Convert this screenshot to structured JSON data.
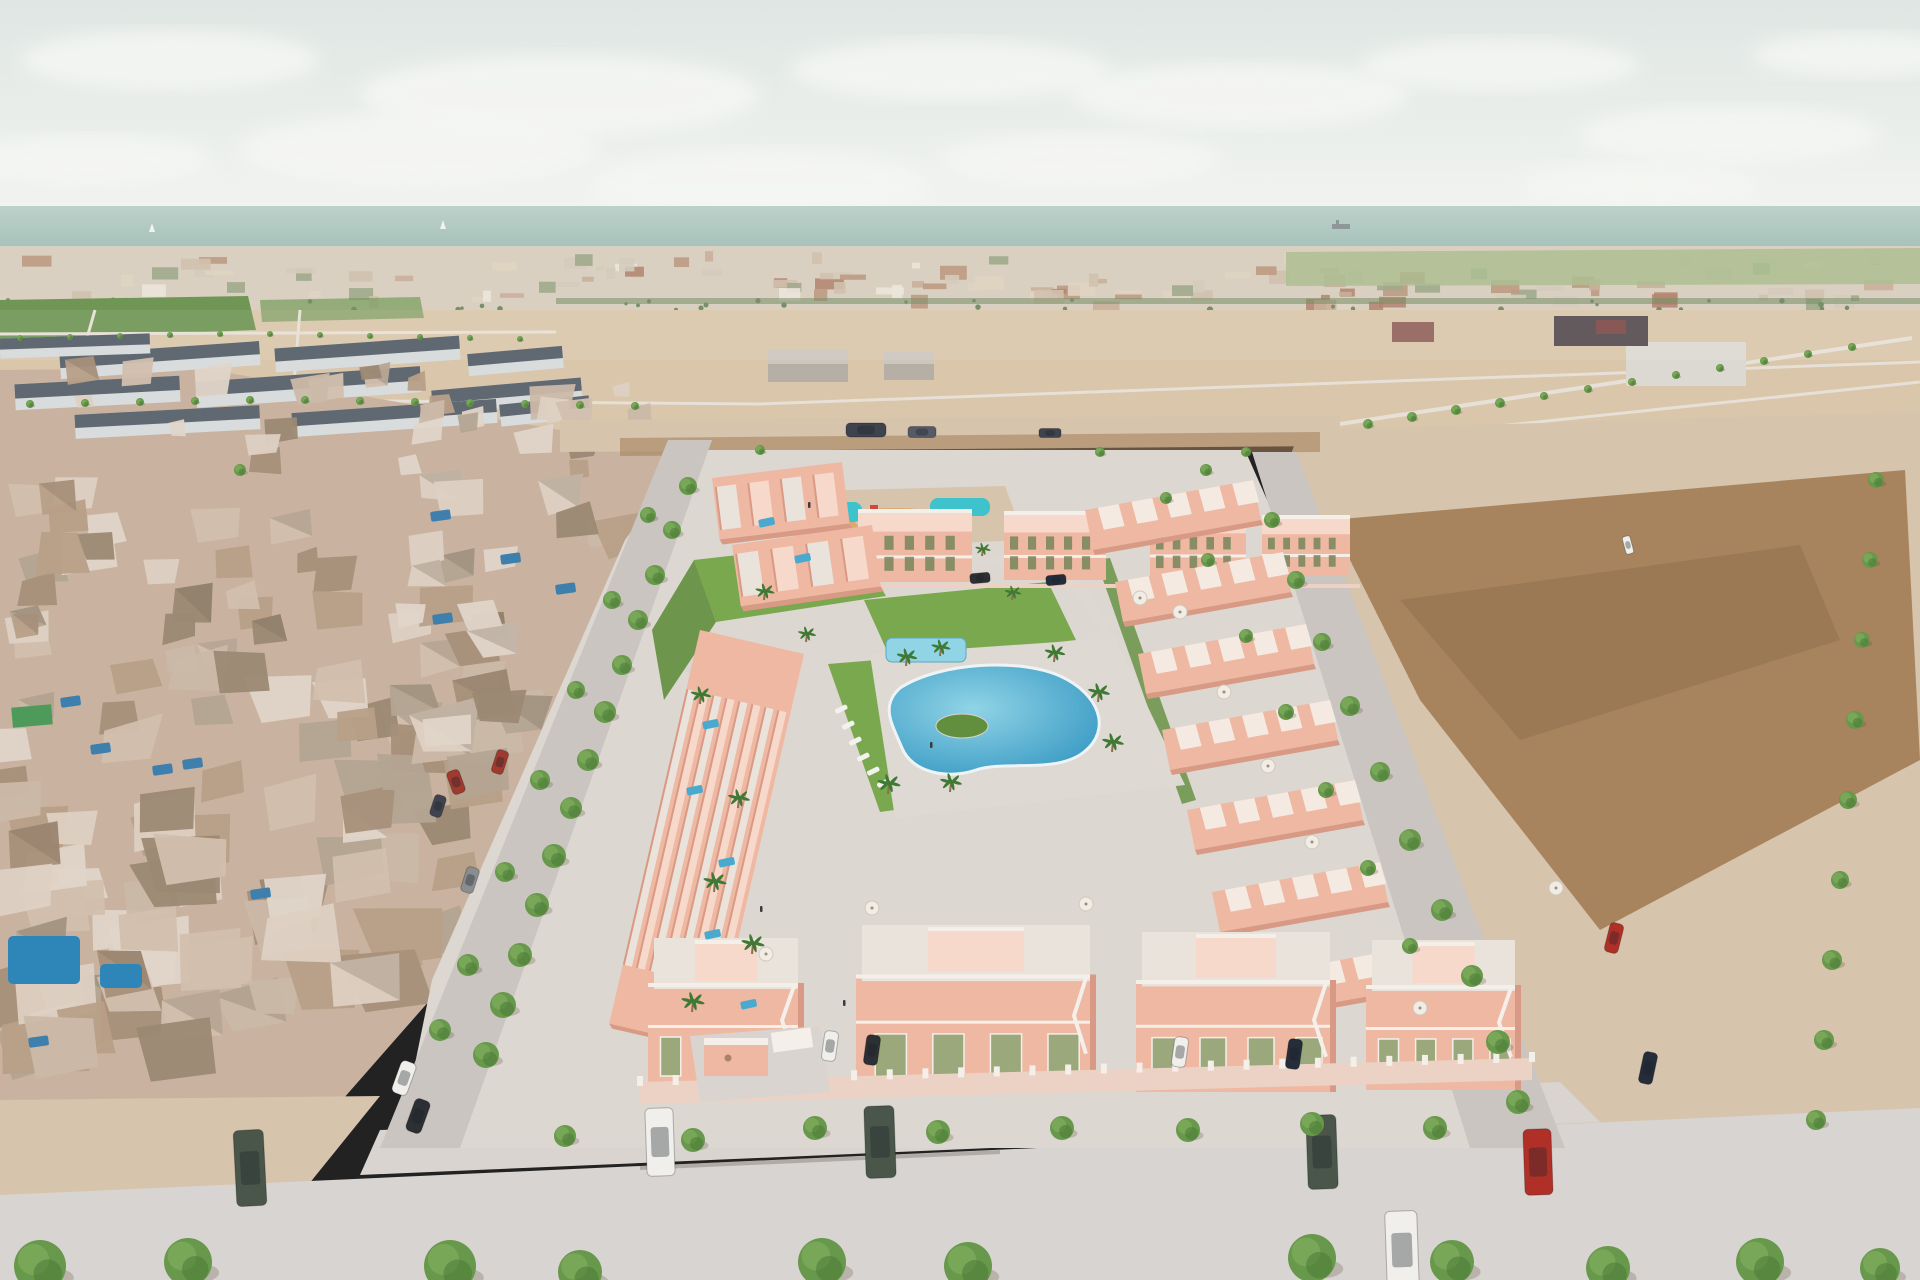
{
  "scene": {
    "description": "Aerial 3D architectural render of a coastal residential development with salmon villas, central lagoon pool, old town on the left, desert plots on the right and sea horizon",
    "entrance_sign": "development entrance plaque (illegible logo)"
  },
  "palette": {
    "skyTop": "#dfe6e3",
    "skyBottom": "#f1f3f0",
    "cloud": "#f6f7f4",
    "sea": "#a6c2ba",
    "seaLight": "#bcd1ca",
    "hullGrey": "#8e9899",
    "cityBase": "#d3c8b6",
    "fieldBase": "#d9c6ab",
    "orchard": "#6f9655",
    "fieldGreenR": "#9db37e",
    "treelineDark": "#5f7a4a",
    "dirt": "#a37e56",
    "dirtDark": "#8a6a48",
    "sand": "#d6c4ad",
    "roadLight": "#d8d4d1",
    "roadMid": "#cac5c1",
    "sidewalk": "#d9d4cf",
    "plate": "#dcd7d1",
    "deck": "#ded9d3",
    "mesh": "#c9b3a0",
    "slateWall": "#d9dcdd",
    "slateRoof": "#525c66",
    "villa": "#eeb8a3",
    "villaShade": "#d89a85",
    "villaTop": "#f6d9ca",
    "whiteTrim": "#f4efe9",
    "olive": "#9aa87c",
    "oliveDark": "#77855c",
    "grass": "#7aa84e",
    "grassDark": "#618f3d",
    "pool": "#4aa9cf",
    "poolDeep": "#2f93c0",
    "poolLight": "#90d4e6",
    "teal": "#3ec3cc",
    "orangeRing": "#dfa05c",
    "tree": "#67984b",
    "treeDark": "#4c7c38",
    "palm": "#3f7a35",
    "trunk": "#8a6f52",
    "carWhite": "#f0efec",
    "carBlack": "#2c2f33",
    "carRed": "#b03028",
    "carRed2": "#a03a2e",
    "carDkGreen": "#4a564a",
    "carNavy": "#252c3a",
    "carGrey": "#8a8d90",
    "truckDark": "#3f434e",
    "truckGrey": "#565a66",
    "fenceWall": "#ecd2c4",
    "people": "#3a3a3a",
    "warehouse": "#b5afa5",
    "warehouseLight": "#ccc7bd",
    "warehouseWhite": "#dcd9d2",
    "darkComplex": "#564d50",
    "maroon": "#7e4a48"
  },
  "objects": {
    "clouds": [
      [
        170,
        60,
        150,
        30
      ],
      [
        420,
        150,
        180,
        36
      ],
      [
        560,
        95,
        200,
        40
      ],
      [
        760,
        185,
        170,
        34
      ],
      [
        950,
        70,
        160,
        30
      ],
      [
        1240,
        95,
        170,
        32
      ],
      [
        1500,
        65,
        140,
        26
      ],
      [
        1730,
        135,
        150,
        28
      ],
      [
        1860,
        55,
        110,
        22
      ],
      [
        90,
        160,
        120,
        24
      ],
      [
        1080,
        160,
        140,
        26
      ],
      [
        1640,
        185,
        120,
        22
      ]
    ],
    "boats": [
      [
        152,
        232
      ],
      [
        443,
        229
      ]
    ],
    "ship": [
      1332,
      224
    ],
    "slateRows": [
      [
        60,
        348,
        200,
        24,
        -4
      ],
      [
        275,
        342,
        185,
        24,
        -4
      ],
      [
        468,
        350,
        95,
        22,
        -5
      ],
      [
        15,
        380,
        165,
        26,
        -3
      ],
      [
        196,
        374,
        225,
        26,
        -4
      ],
      [
        432,
        384,
        150,
        24,
        -5
      ],
      [
        75,
        410,
        185,
        24,
        -3
      ],
      [
        292,
        406,
        205,
        24,
        -4
      ],
      [
        500,
        400,
        90,
        22,
        -6
      ],
      [
        0,
        336,
        150,
        20,
        -2
      ]
    ],
    "meshPools": [
      [
        90,
        745
      ],
      [
        152,
        766
      ],
      [
        60,
        698
      ],
      [
        430,
        512
      ],
      [
        500,
        555
      ],
      [
        555,
        585
      ],
      [
        432,
        615
      ],
      [
        250,
        890
      ],
      [
        182,
        760
      ],
      [
        28,
        1038
      ]
    ],
    "bigPools": [
      [
        8,
        936,
        72,
        48
      ],
      [
        100,
        964,
        42,
        24
      ]
    ],
    "apartments": [
      [
        858,
        512,
        114,
        70
      ],
      [
        1004,
        514,
        102,
        66
      ],
      [
        1150,
        516,
        96,
        62
      ],
      [
        1262,
        518,
        88,
        58
      ]
    ],
    "rightRows": [
      [
        1253,
        480
      ],
      [
        1283,
        552
      ],
      [
        1306,
        624
      ],
      [
        1330,
        700
      ],
      [
        1355,
        780
      ],
      [
        1380,
        862
      ],
      [
        1407,
        948
      ]
    ],
    "leftStrips": [
      [
        712,
        478,
        842,
        462,
        62
      ],
      [
        732,
        545,
        872,
        525,
        62
      ],
      [
        700,
        630,
        804,
        654,
        404
      ]
    ],
    "bottomVillas": [
      [
        648,
        938,
        156,
        150
      ],
      [
        856,
        925,
        240,
        165
      ],
      [
        1136,
        932,
        200,
        160
      ],
      [
        1366,
        940,
        155,
        150
      ]
    ],
    "roofPools": [
      [
        702,
        722
      ],
      [
        686,
        788
      ],
      [
        718,
        860
      ],
      [
        704,
        932
      ],
      [
        740,
        1002
      ],
      [
        724,
        1066
      ],
      [
        758,
        520
      ],
      [
        794,
        556
      ]
    ],
    "loungers": [
      [
        846,
        704
      ],
      [
        853,
        720
      ],
      [
        860,
        736
      ],
      [
        868,
        752
      ],
      [
        878,
        766
      ],
      [
        888,
        778
      ]
    ],
    "umbrellas": [
      [
        1180,
        612
      ],
      [
        1224,
        692
      ],
      [
        1268,
        766
      ],
      [
        1312,
        842
      ],
      [
        872,
        908
      ],
      [
        1086,
        904
      ],
      [
        1556,
        888
      ],
      [
        1420,
        1008
      ],
      [
        766,
        954
      ],
      [
        1140,
        598
      ]
    ],
    "people": [
      [
        808,
        502
      ],
      [
        760,
        906
      ],
      [
        843,
        1000
      ],
      [
        930,
        742
      ]
    ],
    "trees": [
      [
        688,
        486,
        9
      ],
      [
        672,
        530,
        9
      ],
      [
        655,
        575,
        10
      ],
      [
        638,
        620,
        10
      ],
      [
        622,
        665,
        10
      ],
      [
        605,
        712,
        11
      ],
      [
        588,
        760,
        11
      ],
      [
        571,
        808,
        11
      ],
      [
        554,
        856,
        12
      ],
      [
        537,
        905,
        12
      ],
      [
        520,
        955,
        12
      ],
      [
        503,
        1005,
        13
      ],
      [
        486,
        1055,
        13
      ],
      [
        648,
        515,
        8
      ],
      [
        612,
        600,
        9
      ],
      [
        576,
        690,
        9
      ],
      [
        540,
        780,
        10
      ],
      [
        505,
        872,
        10
      ],
      [
        468,
        965,
        11
      ],
      [
        440,
        1030,
        11
      ],
      [
        565,
        1136,
        11
      ],
      [
        693,
        1140,
        12
      ],
      [
        815,
        1128,
        12
      ],
      [
        938,
        1132,
        12
      ],
      [
        1062,
        1128,
        12
      ],
      [
        1188,
        1130,
        12
      ],
      [
        1312,
        1124,
        12
      ],
      [
        1435,
        1128,
        12
      ],
      [
        40,
        1266,
        26
      ],
      [
        188,
        1262,
        24
      ],
      [
        450,
        1266,
        26
      ],
      [
        580,
        1272,
        22
      ],
      [
        822,
        1262,
        24
      ],
      [
        968,
        1266,
        24
      ],
      [
        1312,
        1258,
        24
      ],
      [
        1452,
        1262,
        22
      ],
      [
        1608,
        1268,
        22
      ],
      [
        1760,
        1262,
        24
      ],
      [
        1880,
        1268,
        20
      ],
      [
        1272,
        520,
        8
      ],
      [
        1296,
        580,
        9
      ],
      [
        1322,
        642,
        9
      ],
      [
        1350,
        706,
        10
      ],
      [
        1380,
        772,
        10
      ],
      [
        1410,
        840,
        11
      ],
      [
        1442,
        910,
        11
      ],
      [
        1472,
        976,
        11
      ],
      [
        1498,
        1042,
        12
      ],
      [
        1518,
        1102,
        12
      ],
      [
        1368,
        424,
        5
      ],
      [
        1412,
        417,
        5
      ],
      [
        1456,
        410,
        5
      ],
      [
        1500,
        403,
        5
      ],
      [
        1544,
        396,
        4
      ],
      [
        1588,
        389,
        4
      ],
      [
        1632,
        382,
        4
      ],
      [
        1676,
        375,
        4
      ],
      [
        1720,
        368,
        4
      ],
      [
        1764,
        361,
        4
      ],
      [
        1808,
        354,
        4
      ],
      [
        1852,
        347,
        4
      ],
      [
        1876,
        480,
        8
      ],
      [
        1870,
        560,
        8
      ],
      [
        1862,
        640,
        8
      ],
      [
        1855,
        720,
        9
      ],
      [
        1848,
        800,
        9
      ],
      [
        1840,
        880,
        9
      ],
      [
        1832,
        960,
        10
      ],
      [
        1824,
        1040,
        10
      ],
      [
        1816,
        1120,
        10
      ],
      [
        30,
        404,
        4
      ],
      [
        85,
        403,
        4
      ],
      [
        140,
        402,
        4
      ],
      [
        195,
        401,
        4
      ],
      [
        250,
        400,
        4
      ],
      [
        305,
        400,
        4
      ],
      [
        360,
        401,
        4
      ],
      [
        415,
        402,
        4
      ],
      [
        470,
        403,
        4
      ],
      [
        525,
        404,
        4
      ],
      [
        580,
        405,
        4
      ],
      [
        635,
        406,
        4
      ],
      [
        20,
        338,
        3
      ],
      [
        70,
        337,
        3
      ],
      [
        120,
        336,
        3
      ],
      [
        170,
        335,
        3
      ],
      [
        220,
        334,
        3
      ],
      [
        270,
        334,
        3
      ],
      [
        320,
        335,
        3
      ],
      [
        370,
        336,
        3
      ],
      [
        420,
        337,
        3
      ],
      [
        470,
        338,
        3
      ],
      [
        520,
        339,
        3
      ],
      [
        1208,
        560,
        7
      ],
      [
        1246,
        636,
        7
      ],
      [
        1286,
        712,
        8
      ],
      [
        1326,
        790,
        8
      ],
      [
        1368,
        868,
        8
      ],
      [
        1410,
        946,
        8
      ],
      [
        1166,
        498,
        6
      ],
      [
        1206,
        470,
        6
      ],
      [
        1246,
        452,
        5
      ],
      [
        760,
        450,
        5
      ],
      [
        1100,
        452,
        5
      ],
      [
        240,
        470,
        6
      ]
    ],
    "palms": [
      [
        906,
        666,
        16
      ],
      [
        940,
        656,
        15
      ],
      [
        1054,
        662,
        16
      ],
      [
        1098,
        702,
        17
      ],
      [
        1112,
        752,
        17
      ],
      [
        888,
        794,
        18
      ],
      [
        950,
        792,
        17
      ],
      [
        764,
        600,
        15
      ],
      [
        806,
        642,
        14
      ],
      [
        700,
        704,
        16
      ],
      [
        738,
        808,
        17
      ],
      [
        714,
        892,
        18
      ],
      [
        752,
        954,
        18
      ],
      [
        692,
        1012,
        18
      ],
      [
        1012,
        600,
        13
      ],
      [
        982,
        556,
        12
      ]
    ],
    "cars": [
      [
        250,
        1168,
        30,
        76,
        -3,
        "carDkGreen"
      ],
      [
        660,
        1142,
        28,
        68,
        -2,
        "carWhite"
      ],
      [
        880,
        1142,
        30,
        72,
        -2,
        "carDkGreen"
      ],
      [
        1322,
        1152,
        30,
        74,
        -2,
        "carDkGreen"
      ],
      [
        1402,
        1250,
        32,
        78,
        -2,
        "carWhite"
      ],
      [
        1538,
        1162,
        28,
        66,
        -2,
        "carRed"
      ],
      [
        404,
        1078,
        16,
        34,
        20,
        "carWhite"
      ],
      [
        418,
        1116,
        16,
        34,
        20,
        "carBlack"
      ],
      [
        470,
        880,
        13,
        26,
        18,
        "carGrey"
      ],
      [
        438,
        806,
        12,
        22,
        18,
        "truckDark"
      ],
      [
        500,
        762,
        12,
        24,
        18,
        "carRed2"
      ],
      [
        830,
        1046,
        14,
        30,
        8,
        "carWhite"
      ],
      [
        872,
        1050,
        14,
        30,
        8,
        "carBlack"
      ],
      [
        1180,
        1052,
        14,
        30,
        8,
        "carWhite"
      ],
      [
        1294,
        1054,
        14,
        30,
        8,
        "carNavy"
      ],
      [
        1648,
        1068,
        14,
        32,
        12,
        "carNavy"
      ],
      [
        1614,
        938,
        14,
        30,
        14,
        "carRed"
      ],
      [
        866,
        430,
        14,
        40,
        90,
        "truckDark"
      ],
      [
        922,
        432,
        11,
        28,
        90,
        "truckGrey"
      ],
      [
        1050,
        433,
        9,
        22,
        90,
        "truckDark"
      ],
      [
        980,
        578,
        10,
        20,
        85,
        "carBlack"
      ],
      [
        1056,
        580,
        10,
        20,
        85,
        "carNavy"
      ],
      [
        1628,
        545,
        8,
        18,
        -15,
        "carWhite"
      ],
      [
        456,
        782,
        13,
        24,
        -20,
        "carRed2"
      ]
    ]
  }
}
